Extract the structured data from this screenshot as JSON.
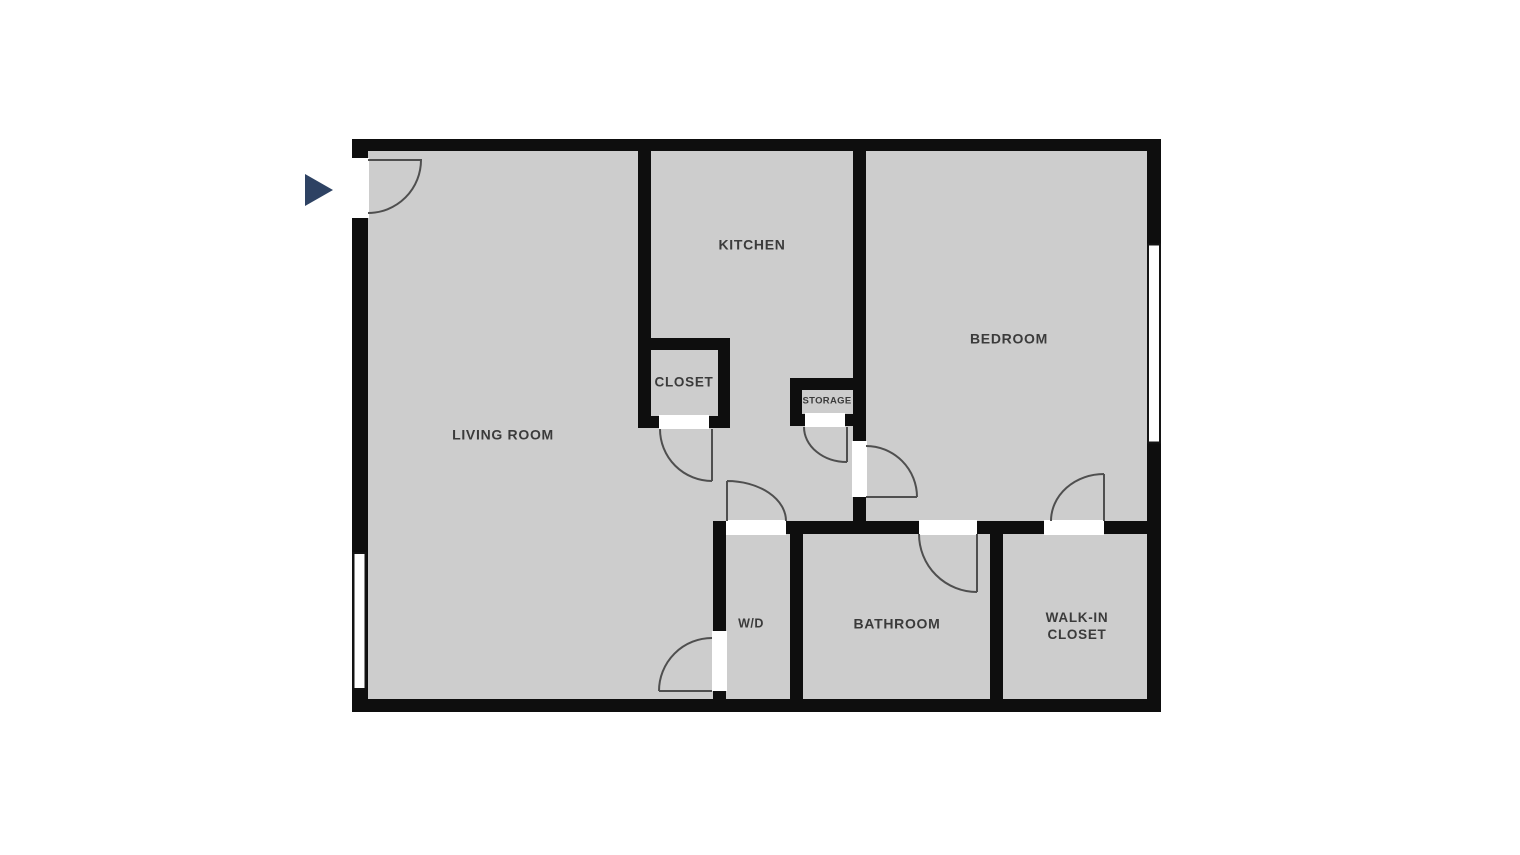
{
  "floorplan": {
    "labels": {
      "living_room": "LIVING ROOM",
      "kitchen": "KITCHEN",
      "closet": "CLOSET",
      "storage": "STORAGE",
      "bedroom": "BEDROOM",
      "washer_dryer": "W/D",
      "bathroom": "BATHROOM",
      "walk_in_closet_line1": "WALK-IN",
      "walk_in_closet_line2": "CLOSET"
    },
    "colors": {
      "background": "#ffffff",
      "floor": "#cdcdcd",
      "wall": "#0e0e0e",
      "door_swing": "#4f4f4f",
      "window_outline": "#141414",
      "entry_arrow": "#2e4263",
      "label_text": "#3b3b3b"
    },
    "entry_arrow_direction": "right"
  }
}
